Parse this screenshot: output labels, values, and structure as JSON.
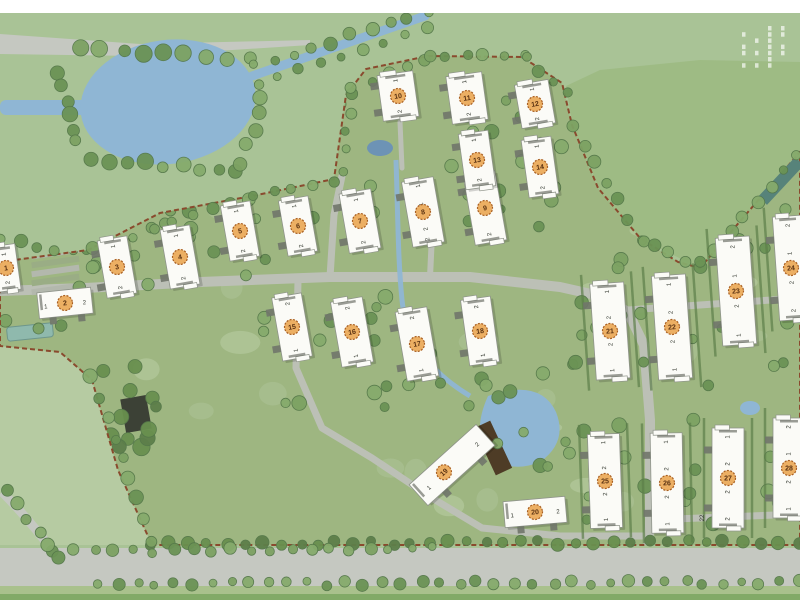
{
  "meta": {
    "type": "residential-development-master-plan",
    "width": 800,
    "height": 600
  },
  "palette": {
    "outer_field": "#a9c396",
    "outer_field_light": "#b6cba2",
    "dip_field": "#9cba81",
    "site_fill": "#9eb681",
    "road_external": "#c5c8c1",
    "road_internal": "#bcc0b6",
    "water": "#8fb6d4",
    "water_dark": "#6d93b5",
    "boundary": "#8a4a2e",
    "building_fill": "#fbfbf7",
    "building_stroke": "#8f948a",
    "badge_fill": "#ecaf63",
    "badge_ring": "#a85f22",
    "badge_text": "#5a3212",
    "unit_label": "#33382f",
    "tree_greens": [
      "#7da263",
      "#6b9355",
      "#86ab6c"
    ],
    "tree_dark_greens": [
      "#5d7f4a",
      "#69904f"
    ],
    "tree_stroke": "#55784a",
    "lawn_patches": [
      "#aec49a",
      "#bccfa8"
    ],
    "hedge": "#5d7f4a",
    "deck_brown": "#4e3c26",
    "clubhouse_dark": "#3c4136",
    "pool_teal": "#8fb9ad",
    "lap_pool_teal": "#57837a",
    "stub_gray": "#70756a",
    "top_strip": "#ffffff",
    "bottom_verge": "#a9c18c",
    "bottom_edge": "#82aa67"
  },
  "corner_text_block": {
    "legible": false,
    "columns": 4,
    "rows": 7,
    "note": "tiny vertical plan-title text, unreadable at source resolution"
  },
  "surroundings": {
    "top_strip_height": 13,
    "top_left_road": [
      [
        0,
        34
      ],
      [
        140,
        44
      ],
      [
        310,
        40
      ],
      [
        310,
        45
      ],
      [
        140,
        56
      ],
      [
        0,
        54
      ]
    ],
    "bottom_road": {
      "x": 0,
      "y": 548,
      "w": 800,
      "h": 40
    },
    "bottom_verge": {
      "x": 0,
      "y": 586,
      "w": 800,
      "h": 14
    },
    "bottom_edge_band": {
      "x": 0,
      "y": 594,
      "w": 800,
      "h": 6
    },
    "left_field_light": [
      [
        0,
        346
      ],
      [
        60,
        352
      ],
      [
        92,
        380
      ],
      [
        118,
        470
      ],
      [
        152,
        545
      ],
      [
        0,
        545
      ]
    ],
    "dip_field": [
      [
        566,
        86
      ],
      [
        573,
        128
      ],
      [
        600,
        190
      ],
      [
        642,
        240
      ],
      [
        700,
        268
      ],
      [
        752,
        210
      ],
      [
        800,
        150
      ],
      [
        800,
        62
      ],
      [
        700,
        60
      ],
      [
        600,
        70
      ]
    ],
    "curve_road": "M2,492 Q30,520 58,558",
    "lake": {
      "cx": 168,
      "cy": 102,
      "rx": 88,
      "ry": 62,
      "rot": -8,
      "arm": {
        "x": 0,
        "y": 100,
        "w": 100,
        "h": 15
      }
    },
    "canal": {
      "x1": 252,
      "y1": 76,
      "x2": 425,
      "y2": 16,
      "width": 9
    }
  },
  "site": {
    "boundary": [
      [
        0,
        262
      ],
      [
        88,
        250
      ],
      [
        160,
        213
      ],
      [
        252,
        196
      ],
      [
        334,
        179
      ],
      [
        346,
        95
      ],
      [
        366,
        69
      ],
      [
        428,
        56
      ],
      [
        522,
        57
      ],
      [
        562,
        83
      ],
      [
        572,
        125
      ],
      [
        598,
        188
      ],
      [
        640,
        238
      ],
      [
        678,
        262
      ],
      [
        700,
        268
      ],
      [
        748,
        212
      ],
      [
        800,
        152
      ],
      [
        800,
        545
      ],
      [
        152,
        545
      ],
      [
        118,
        470
      ],
      [
        92,
        380
      ],
      [
        60,
        352
      ],
      [
        0,
        346
      ]
    ],
    "roads": [
      {
        "d": "M0,291 L85,288 L200,282 L330,277 L470,277 L560,287 L600,296 L628,312 L644,345 L650,420 L650,520 L648,544",
        "w": 10
      },
      {
        "d": "M330,277 L334,215 L342,176",
        "w": 7
      },
      {
        "d": "M430,277 L432,235",
        "w": 6
      },
      {
        "d": "M628,310 L800,298",
        "w": 7
      },
      {
        "d": "M650,520 L800,514",
        "w": 7
      },
      {
        "d": "M298,281 L296,368 L322,428 L372,458 L432,498 L482,528 L560,536 L648,536",
        "w": 7
      },
      {
        "d": "M400,122 L402,168",
        "w": 5
      }
    ],
    "stream": "M396,160 C398,220 398,260 402,300 C406,340 430,372 470,396",
    "central_pond": "M488,396 Q540,378 556,412 Q568,442 540,462 Q510,474 492,456 Q470,436 488,396 Z",
    "small_pond_top": {
      "cx": 380,
      "cy": 148,
      "rx": 13,
      "ry": 8
    },
    "small_pond_right": {
      "cx": 750,
      "cy": 408,
      "rx": 10,
      "ry": 7
    },
    "deck": {
      "x": 493,
      "y": 448,
      "w": 18,
      "h": 52,
      "rot": -25
    },
    "clubhouse": {
      "x": 136,
      "y": 414,
      "w": 26,
      "h": 34,
      "rot": -10
    },
    "left_pool": {
      "x": 30,
      "y": 332,
      "w": 46,
      "h": 14,
      "rot": -6
    },
    "lap_pool": {
      "x": 781,
      "y": 181,
      "w": 54,
      "h": 12,
      "rot": -47
    },
    "parking_rows": {
      "cx": 55,
      "y0": 250,
      "step": 9,
      "count": 5,
      "w": 48,
      "h": 6,
      "rot": -8
    },
    "buildings": [
      {
        "id": 1,
        "x": 6,
        "y": 268,
        "w": 24,
        "h": 46,
        "rot": -8,
        "badge": "1",
        "labels": [
          [
            -0.3,
            "1"
          ],
          [
            0.32,
            "2"
          ]
        ]
      },
      {
        "id": 2,
        "x": 65,
        "y": 303,
        "w": 54,
        "h": 26,
        "rot": -6,
        "badge": "2",
        "labels": [
          [
            -0.36,
            "1"
          ],
          [
            0.36,
            "2"
          ]
        ]
      },
      {
        "id": 3,
        "x": 117,
        "y": 267,
        "w": 30,
        "h": 58,
        "rot": -10,
        "badge": "3",
        "labels": [
          [
            -0.36,
            "1"
          ],
          [
            0.36,
            "2"
          ]
        ]
      },
      {
        "id": 4,
        "x": 180,
        "y": 257,
        "w": 30,
        "h": 60,
        "rot": -10,
        "badge": "4",
        "labels": [
          [
            -0.36,
            "1"
          ],
          [
            0.36,
            "2"
          ]
        ]
      },
      {
        "id": 5,
        "x": 240,
        "y": 231,
        "w": 30,
        "h": 56,
        "rot": -10,
        "badge": "5",
        "labels": [
          [
            -0.36,
            "1"
          ],
          [
            0.36,
            "2"
          ]
        ]
      },
      {
        "id": 6,
        "x": 298,
        "y": 226,
        "w": 30,
        "h": 56,
        "rot": -10,
        "badge": "6",
        "labels": [
          [
            -0.36,
            "1"
          ],
          [
            0.36,
            "2"
          ]
        ]
      },
      {
        "id": 7,
        "x": 360,
        "y": 221,
        "w": 32,
        "h": 60,
        "rot": -10,
        "badge": "7",
        "labels": [
          [
            -0.36,
            "1"
          ],
          [
            0.36,
            "2"
          ]
        ]
      },
      {
        "id": 8,
        "x": 423,
        "y": 212,
        "w": 32,
        "h": 66,
        "rot": -10,
        "badge": "8",
        "labels": [
          [
            -0.4,
            "1"
          ],
          [
            -0.12,
            "1"
          ],
          [
            0.26,
            "2"
          ],
          [
            0.42,
            "2"
          ]
        ]
      },
      {
        "id": 9,
        "x": 485,
        "y": 208,
        "w": 32,
        "h": 70,
        "rot": -10,
        "badge": "9",
        "labels": [
          [
            -0.38,
            "1"
          ],
          [
            0.38,
            "2"
          ]
        ]
      },
      {
        "id": 10,
        "x": 398,
        "y": 96,
        "w": 36,
        "h": 46,
        "rot": -8,
        "badge": "10",
        "labels": [
          [
            -0.34,
            "1"
          ],
          [
            0.34,
            "2"
          ]
        ]
      },
      {
        "id": 11,
        "x": 467,
        "y": 98,
        "w": 36,
        "h": 48,
        "rot": -8,
        "badge": "11",
        "labels": [
          [
            -0.34,
            "1"
          ],
          [
            0.34,
            "2"
          ]
        ]
      },
      {
        "id": 12,
        "x": 535,
        "y": 104,
        "w": 34,
        "h": 44,
        "rot": -10,
        "badge": "12",
        "labels": [
          [
            -0.34,
            "1"
          ],
          [
            0.34,
            "2"
          ]
        ]
      },
      {
        "id": 13,
        "x": 477,
        "y": 160,
        "w": 30,
        "h": 56,
        "rot": -8,
        "badge": "13",
        "labels": [
          [
            -0.36,
            "1"
          ],
          [
            0.36,
            "2"
          ]
        ]
      },
      {
        "id": 14,
        "x": 540,
        "y": 167,
        "w": 30,
        "h": 58,
        "rot": -8,
        "badge": "14",
        "labels": [
          [
            -0.36,
            "1"
          ],
          [
            0.36,
            "2"
          ]
        ]
      },
      {
        "id": 15,
        "x": 292,
        "y": 327,
        "w": 30,
        "h": 64,
        "rot": -10,
        "badge": "15",
        "labels": [
          [
            -0.37,
            "2"
          ],
          [
            0.37,
            "1"
          ]
        ]
      },
      {
        "id": 16,
        "x": 352,
        "y": 332,
        "w": 32,
        "h": 66,
        "rot": -10,
        "badge": "16",
        "labels": [
          [
            -0.37,
            "2"
          ],
          [
            0.37,
            "1"
          ]
        ]
      },
      {
        "id": 17,
        "x": 417,
        "y": 344,
        "w": 32,
        "h": 70,
        "rot": -10,
        "badge": "17",
        "labels": [
          [
            -0.38,
            "2"
          ],
          [
            0.38,
            "1"
          ]
        ]
      },
      {
        "id": 18,
        "x": 480,
        "y": 331,
        "w": 30,
        "h": 66,
        "rot": -8,
        "badge": "18",
        "labels": [
          [
            -0.37,
            "2"
          ],
          [
            0.37,
            "1"
          ]
        ]
      },
      {
        "id": 19,
        "x": 452,
        "y": 465,
        "w": 90,
        "h": 28,
        "rot": -42,
        "badge": "19",
        "badge_t": -0.12,
        "labels": [
          [
            -0.36,
            "1"
          ],
          [
            0.36,
            "2"
          ]
        ]
      },
      {
        "id": 20,
        "x": 535,
        "y": 512,
        "w": 62,
        "h": 26,
        "rot": -5,
        "badge": "20",
        "labels": [
          [
            -0.37,
            "1"
          ],
          [
            0.37,
            "2"
          ]
        ]
      },
      {
        "id": 21,
        "x": 610,
        "y": 331,
        "w": 34,
        "h": 96,
        "rot": -4,
        "badge": "21",
        "hedges": true,
        "labels": [
          [
            -0.41,
            "1"
          ],
          [
            -0.14,
            "2"
          ],
          [
            0.14,
            "2"
          ],
          [
            0.41,
            "1"
          ]
        ]
      },
      {
        "id": 22,
        "x": 672,
        "y": 327,
        "w": 34,
        "h": 104,
        "rot": -4,
        "badge": "22",
        "hedges": true,
        "labels": [
          [
            -0.41,
            "1"
          ],
          [
            -0.14,
            "2"
          ],
          [
            0.14,
            "2"
          ],
          [
            0.41,
            "1"
          ]
        ]
      },
      {
        "id": 23,
        "x": 736,
        "y": 291,
        "w": 34,
        "h": 108,
        "rot": -4,
        "badge": "23",
        "hedges": true,
        "labels": [
          [
            -0.41,
            "2"
          ],
          [
            -0.14,
            "1"
          ],
          [
            0.14,
            "2"
          ],
          [
            0.41,
            "1"
          ]
        ]
      },
      {
        "id": 24,
        "x": 791,
        "y": 268,
        "w": 30,
        "h": 104,
        "rot": -4,
        "badge": "24",
        "hedges": true,
        "labels": [
          [
            -0.41,
            "2"
          ],
          [
            -0.14,
            "1"
          ],
          [
            0.14,
            "2"
          ],
          [
            0.41,
            "2"
          ]
        ]
      },
      {
        "id": 25,
        "x": 605,
        "y": 481,
        "w": 32,
        "h": 94,
        "rot": -2,
        "badge": "25",
        "hedges": true,
        "labels": [
          [
            -0.41,
            "1"
          ],
          [
            -0.14,
            "2"
          ],
          [
            0.14,
            "2"
          ],
          [
            0.41,
            "1"
          ]
        ]
      },
      {
        "id": 26,
        "x": 667,
        "y": 483,
        "w": 32,
        "h": 100,
        "rot": -1,
        "badge": "26",
        "hedges": true,
        "labels": [
          [
            -0.41,
            "1"
          ],
          [
            -0.14,
            "2"
          ],
          [
            0.14,
            "2"
          ],
          [
            0.41,
            "1"
          ]
        ]
      },
      {
        "id": 27,
        "x": 728,
        "y": 478,
        "w": 32,
        "h": 100,
        "rot": 0,
        "badge": "27",
        "hedges": true,
        "side": [
          -24,
          40,
          "22"
        ],
        "labels": [
          [
            -0.41,
            "1"
          ],
          [
            -0.14,
            "2"
          ],
          [
            0.14,
            "2"
          ],
          [
            0.41,
            "2"
          ]
        ]
      },
      {
        "id": 28,
        "x": 789,
        "y": 468,
        "w": 32,
        "h": 100,
        "rot": 0,
        "badge": "28",
        "hedges": true,
        "labels": [
          [
            -0.41,
            "2"
          ],
          [
            -0.14,
            "1"
          ],
          [
            0.14,
            "2"
          ],
          [
            0.41,
            "1"
          ]
        ]
      }
    ],
    "tree_belts": [
      {
        "a": [
          80,
          48
        ],
        "b": [
          248,
          60
        ],
        "n": 9,
        "r": 7
      },
      {
        "a": [
          58,
          72
        ],
        "b": [
          78,
          142
        ],
        "n": 6,
        "r": 7
      },
      {
        "a": [
          92,
          158
        ],
        "b": [
          238,
          172
        ],
        "n": 9,
        "r": 7
      },
      {
        "a": [
          243,
          162
        ],
        "b": [
          263,
          96
        ],
        "n": 5,
        "r": 6
      },
      {
        "a": [
          255,
          66
        ],
        "b": [
          428,
          12
        ],
        "n": 10,
        "r": 5.5
      },
      {
        "a": [
          258,
          84
        ],
        "b": [
          425,
          28
        ],
        "n": 9,
        "r": 5
      },
      {
        "a": [
          95,
          248
        ],
        "b": [
          250,
          198
        ],
        "n": 9,
        "r": 5.5
      },
      {
        "a": [
          252,
          196
        ],
        "b": [
          332,
          180
        ],
        "n": 5,
        "r": 5
      },
      {
        "a": [
          344,
          170
        ],
        "b": [
          350,
          95
        ],
        "n": 5,
        "r": 5
      },
      {
        "a": [
          352,
          90
        ],
        "b": [
          425,
          58
        ],
        "n": 5,
        "r": 5
      },
      {
        "a": [
          428,
          55
        ],
        "b": [
          523,
          56
        ],
        "n": 6,
        "r": 5
      },
      {
        "a": [
          526,
          58
        ],
        "b": [
          568,
          92
        ],
        "n": 4,
        "r": 5
      },
      {
        "a": [
          573,
          126
        ],
        "b": [
          640,
          238
        ],
        "n": 7,
        "r": 5.5
      },
      {
        "a": [
          642,
          240
        ],
        "b": [
          698,
          266
        ],
        "n": 5,
        "r": 5.5
      },
      {
        "a": [
          702,
          264
        ],
        "b": [
          798,
          154
        ],
        "n": 8,
        "r": 5.5
      },
      {
        "a": [
          152,
          544
        ],
        "b": [
          798,
          542
        ],
        "n": 36,
        "r": 5.5,
        "dark": true
      },
      {
        "a": [
          92,
          378
        ],
        "b": [
          150,
          540
        ],
        "n": 9,
        "r": 6
      },
      {
        "a": [
          100,
          584
        ],
        "b": [
          798,
          582
        ],
        "n": 38,
        "r": 5
      },
      {
        "a": [
          55,
          552
        ],
        "b": [
          430,
          548
        ],
        "n": 20,
        "r": 5
      },
      {
        "a": [
          8,
          492
        ],
        "b": [
          60,
          556
        ],
        "n": 6,
        "r": 5.5
      },
      {
        "a": [
          0,
          240
        ],
        "b": [
          55,
          250
        ],
        "n": 4,
        "r": 6
      }
    ],
    "tree_scatter": [
      {
        "x": 95,
        "y": 200,
        "w": 240,
        "h": 85,
        "n": 16,
        "r": 6
      },
      {
        "x": 335,
        "y": 95,
        "w": 230,
        "h": 105,
        "n": 14,
        "r": 6
      },
      {
        "x": 250,
        "y": 285,
        "w": 240,
        "h": 125,
        "n": 20,
        "r": 6
      },
      {
        "x": 95,
        "y": 360,
        "w": 85,
        "h": 90,
        "n": 12,
        "r": 7,
        "dark": true
      },
      {
        "x": 465,
        "y": 370,
        "w": 120,
        "h": 105,
        "n": 14,
        "r": 6
      },
      {
        "x": 555,
        "y": 235,
        "w": 130,
        "h": 130,
        "n": 12,
        "r": 6
      },
      {
        "x": 585,
        "y": 415,
        "w": 215,
        "h": 115,
        "n": 16,
        "r": 6
      },
      {
        "x": 700,
        "y": 165,
        "w": 95,
        "h": 95,
        "n": 9,
        "r": 6
      },
      {
        "x": 0,
        "y": 250,
        "w": 95,
        "h": 95,
        "n": 9,
        "r": 6
      },
      {
        "x": 345,
        "y": 170,
        "w": 210,
        "h": 60,
        "n": 10,
        "r": 5.5
      },
      {
        "x": 585,
        "y": 300,
        "w": 210,
        "h": 100,
        "n": 12,
        "r": 5.5
      }
    ],
    "lawn_patches": {
      "x": 10,
      "y": 185,
      "w": 780,
      "h": 350,
      "n": 26
    }
  }
}
